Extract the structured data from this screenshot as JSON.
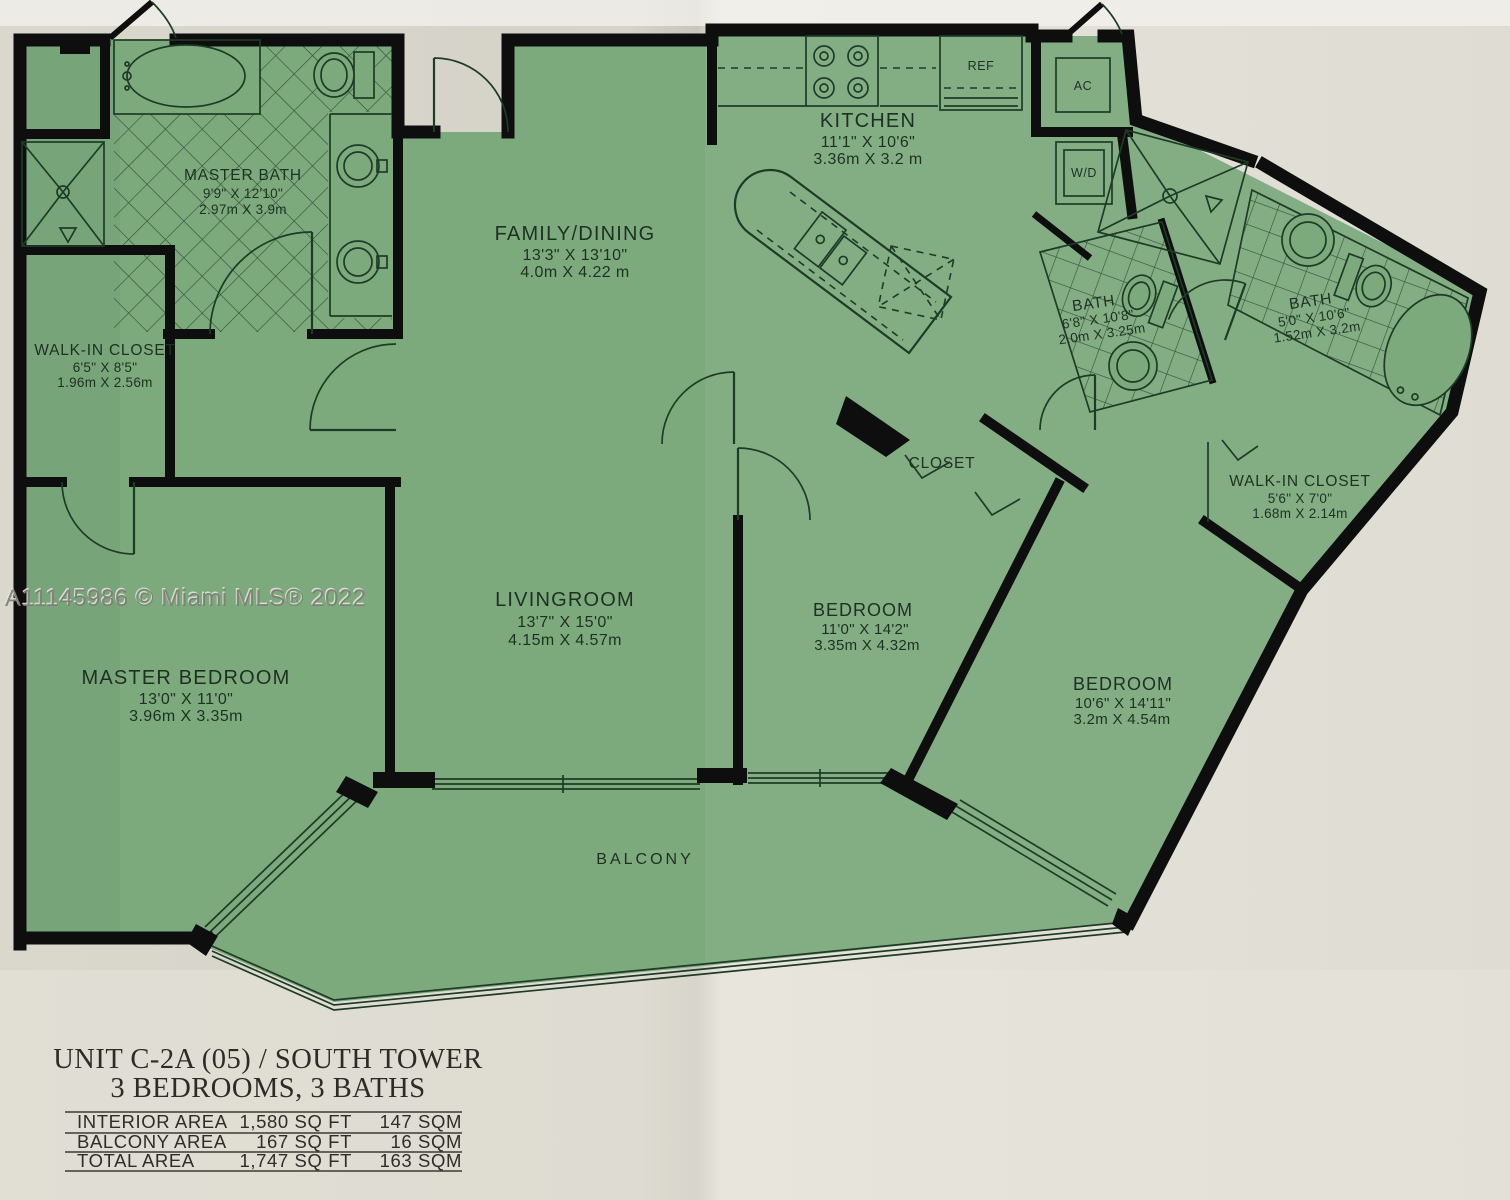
{
  "watermark": "A11145986 © Miami MLS® 2022",
  "title": {
    "line1": "UNIT C-2A (05) / SOUTH TOWER",
    "line2": "3 BEDROOMS, 3 BATHS"
  },
  "area_table": {
    "rows": [
      {
        "label": "INTERIOR AREA",
        "sqft": "1,580 SQ FT",
        "sqm": "147 SQM"
      },
      {
        "label": "BALCONY AREA",
        "sqft": "167 SQ FT",
        "sqm": "16 SQM"
      },
      {
        "label": "TOTAL AREA",
        "sqft": "1,747 SQ FT",
        "sqm": "163 SQM"
      }
    ]
  },
  "rooms": {
    "master_bath": {
      "name": "MASTER BATH",
      "ft": "9'9\" X 12'10\"",
      "m": "2.97m X 3.9m"
    },
    "wic_left": {
      "name": "WALK-IN CLOSET",
      "ft": "6'5\" X 8'5\"",
      "m": "1.96m X 2.56m"
    },
    "family_dining": {
      "name": "FAMILY/DINING",
      "ft": "13'3\" X 13'10\"",
      "m": "4.0m X 4.22 m"
    },
    "kitchen": {
      "name": "KITCHEN",
      "ft": "11'1\" X 10'6\"",
      "m": "3.36m X 3.2 m"
    },
    "bath_mid": {
      "name": "BATH",
      "ft": "6'8\" X 10'8\"",
      "m": "2.0m X 3.25m"
    },
    "bath_right": {
      "name": "BATH",
      "ft": "5'0\" X 10'6\"",
      "m": "1.52m X 3.2m"
    },
    "wic_right": {
      "name": "WALK-IN CLOSET",
      "ft": "5'6\" X 7'0\"",
      "m": "1.68m X 2.14m"
    },
    "closet": {
      "name": "CLOSET"
    },
    "livingroom": {
      "name": "LIVINGROOM",
      "ft": "13'7\" X 15'0\"",
      "m": "4.15m X 4.57m"
    },
    "master_bedroom": {
      "name": "MASTER BEDROOM",
      "ft": "13'0\" X 11'0\"",
      "m": "3.96m X 3.35m"
    },
    "bedroom_mid": {
      "name": "BEDROOM",
      "ft": "11'0\" X 14'2\"",
      "m": "3.35m X 4.32m"
    },
    "bedroom_right": {
      "name": "BEDROOM",
      "ft": "10'6\" X 14'11\"",
      "m": "3.2m X 4.54m"
    },
    "balcony": {
      "name": "BALCONY"
    }
  },
  "appliances": {
    "ref": "REF",
    "ac": "AC",
    "wd": "W/D"
  },
  "colors": {
    "paper": "#dedcd2",
    "plan_green": "#7caa7d",
    "wall": "#0d0e0d",
    "line": "#1e3b26"
  }
}
